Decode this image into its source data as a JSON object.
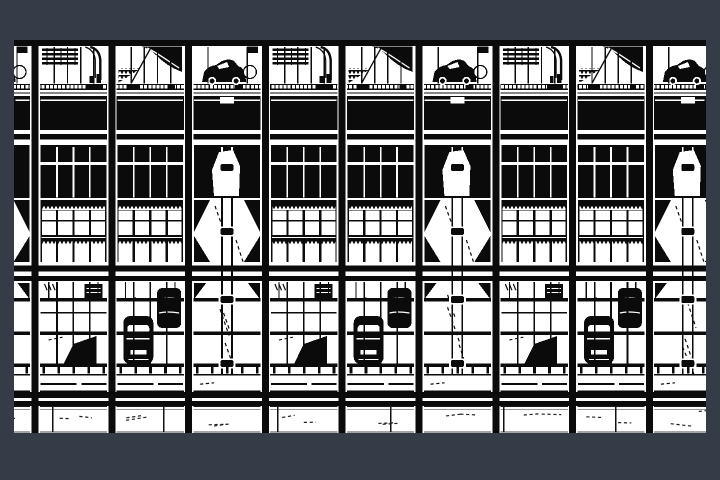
{
  "viewer": {
    "description": "black-and-white architectural elevation drawing of a multi-storey high-tech building facade with repeating glazed bays, parked-car silhouettes, hatch bands and service bays",
    "background_color": "#353c47",
    "ink_color": "#0b0b0b",
    "paper_color": "#ffffff",
    "faint_gray": "#999999",
    "dark_gray": "#333333"
  },
  "drawing": {
    "area": {
      "x": 14,
      "y": 40,
      "w": 692,
      "h": 393
    },
    "piers": {
      "start": 35,
      "period": 76.8,
      "count": 9,
      "width": 7,
      "inset": 5.5,
      "flank": 1.3
    },
    "variant_cycle": "SAB",
    "bands": {
      "top_black": [
        40,
        46
      ],
      "gallery": [
        46,
        84
      ],
      "tick_band": [
        84,
        90
      ],
      "string_lines": [
        92.5,
        96.0
      ],
      "spandrel": [
        97,
        130
      ],
      "floor1": [
        134,
        139.5
      ],
      "transom": [
        145,
        198
      ],
      "transom_split": [
        162.2,
        164.8
      ],
      "zig1_solid": [
        200,
        206
      ],
      "zig1_teeth": [
        206,
        210.5
      ],
      "window_upper": [
        210,
        235
      ],
      "thin_rail": [
        220,
        221.6
      ],
      "rail_band": [
        235,
        240
      ],
      "zig2_teeth": [
        240,
        244.5
      ],
      "window_lower": [
        245,
        262
      ],
      "heavy1": [
        265.5,
        271.5
      ],
      "heavy2": [
        276,
        281
      ],
      "deck": [
        281,
        366
      ],
      "deck_rails": [
        298,
        331.5,
        363.5
      ],
      "posts": [
        367,
        374
      ],
      "post_line": [
        374,
        375.4
      ],
      "fascia_mark": [
        383.2,
        384.8
      ],
      "fascia_line": [
        390.3,
        391.8
      ],
      "ground_band1": [
        392,
        398
      ],
      "ground_band2": [
        401,
        406
      ],
      "glass": [
        406,
        432
      ],
      "bottom_edge": [
        431.4,
        432.6
      ]
    },
    "spandrel_panel_gap": 4,
    "vent_notch": {
      "w": 14,
      "h": 6.4
    },
    "mullions": {
      "window_cols": 4,
      "gallery_cols": 5
    },
    "ladder": {
      "half_gap": 5,
      "block_w": 13,
      "block_h": 7,
      "block_ys": [
        164,
        228,
        296,
        360
      ]
    },
    "corner_triangles": {
      "w": 16,
      "row1": [
        200,
        232
      ],
      "row2": [
        236,
        262
      ],
      "deck_y": 283,
      "deck_w": 12,
      "deck_h": 16
    },
    "ground_dividers": [
      52,
      163,
      277,
      390,
      503,
      615
    ],
    "sketch": {
      "seed": 7,
      "glass_scribbles_per_bay": 2,
      "deck_scribbles_per_special_bay": 3
    }
  }
}
